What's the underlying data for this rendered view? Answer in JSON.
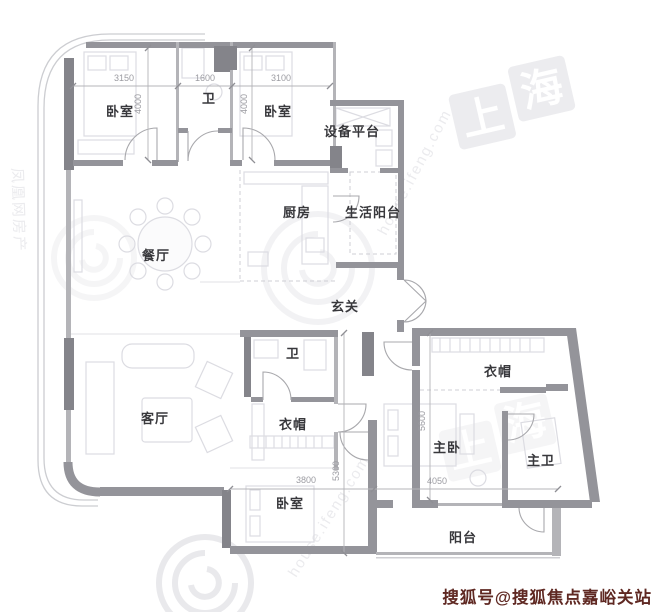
{
  "page": {
    "credit": "搜狐号@搜狐焦点嘉峪关站"
  },
  "rooms": [
    {
      "id": "bedroom-top-left",
      "label": "卧室"
    },
    {
      "id": "bath-top",
      "label": "卫"
    },
    {
      "id": "bedroom-top-right",
      "label": "卧室"
    },
    {
      "id": "equipment-platform",
      "label": "设备平台"
    },
    {
      "id": "kitchen",
      "label": "厨房"
    },
    {
      "id": "service-balcony",
      "label": "生活阳台"
    },
    {
      "id": "dining-room",
      "label": "餐厅"
    },
    {
      "id": "foyer",
      "label": "玄关"
    },
    {
      "id": "bath-middle",
      "label": "卫"
    },
    {
      "id": "cloakroom-middle",
      "label": "衣帽"
    },
    {
      "id": "living-room",
      "label": "客厅"
    },
    {
      "id": "cloakroom-master",
      "label": "衣帽"
    },
    {
      "id": "master-bedroom",
      "label": "主卧"
    },
    {
      "id": "master-bath",
      "label": "主卫"
    },
    {
      "id": "bedroom-bottom",
      "label": "卧室"
    },
    {
      "id": "balcony",
      "label": "阳台"
    }
  ],
  "dimensions": [
    {
      "label": "3150"
    },
    {
      "label": "1600"
    },
    {
      "label": "3100"
    },
    {
      "label": "4000"
    },
    {
      "label": "4000"
    },
    {
      "label": "5600"
    },
    {
      "label": "5300"
    },
    {
      "label": "3800"
    },
    {
      "label": "4050"
    }
  ],
  "watermarks": {
    "city_chars": [
      "上",
      "海"
    ],
    "portal_text": "house.ifeng.com",
    "brand_text": "凤凰网房产"
  },
  "colors": {
    "credit_red": "#5f2822",
    "wall_gray": "#94949a",
    "label_dark": "#38383c",
    "dimension_gray": "#9c9ca2",
    "watermark_gray": "#ececef"
  }
}
